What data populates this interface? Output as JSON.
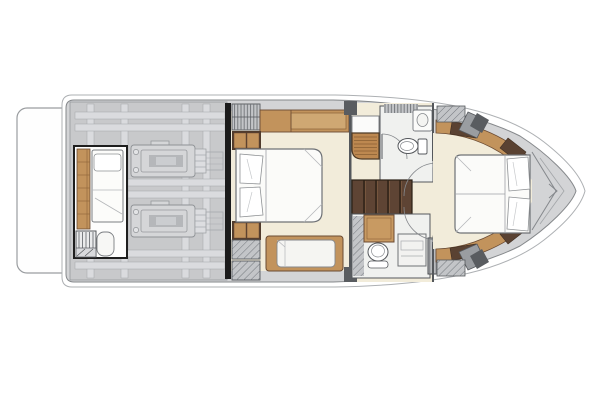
{
  "diagram": {
    "label": "motor-yacht-lower-deck-floor-plan",
    "orientation": "bow-right",
    "regions": [
      "swim-platform",
      "engine-room",
      "port-engine",
      "starboard-engine",
      "crew-cabin",
      "crew-berth",
      "crew-wardrobe",
      "crew-ladder",
      "main-bulkhead",
      "master-cabin",
      "master-berth",
      "master-wardrobe",
      "master-storage-cubbies",
      "master-sofa",
      "master-lockers",
      "master-shower",
      "master-vanity",
      "master-head-toilet",
      "companionway-stairs",
      "forward-head",
      "forward-shower",
      "forward-toilet",
      "forward-vanity",
      "cabin-doors",
      "vip-cabin",
      "vip-berth",
      "vip-trim",
      "bow-anchor-locker"
    ]
  },
  "palette": {
    "background": "#ffffff",
    "deck": "#d3d4d6",
    "engineroom": "#c8c9cb",
    "frame": "#dadbde",
    "floor": "#f2ecda",
    "wood": "#c2935c",
    "teak": "#bd8850",
    "darkwood": "#5a4232",
    "stairs": "#5e4434",
    "hatchfill": "#c3c5c8",
    "outline": "#55585c",
    "bulkhead": "#1b1b1b",
    "white": "#fbfbf9"
  }
}
